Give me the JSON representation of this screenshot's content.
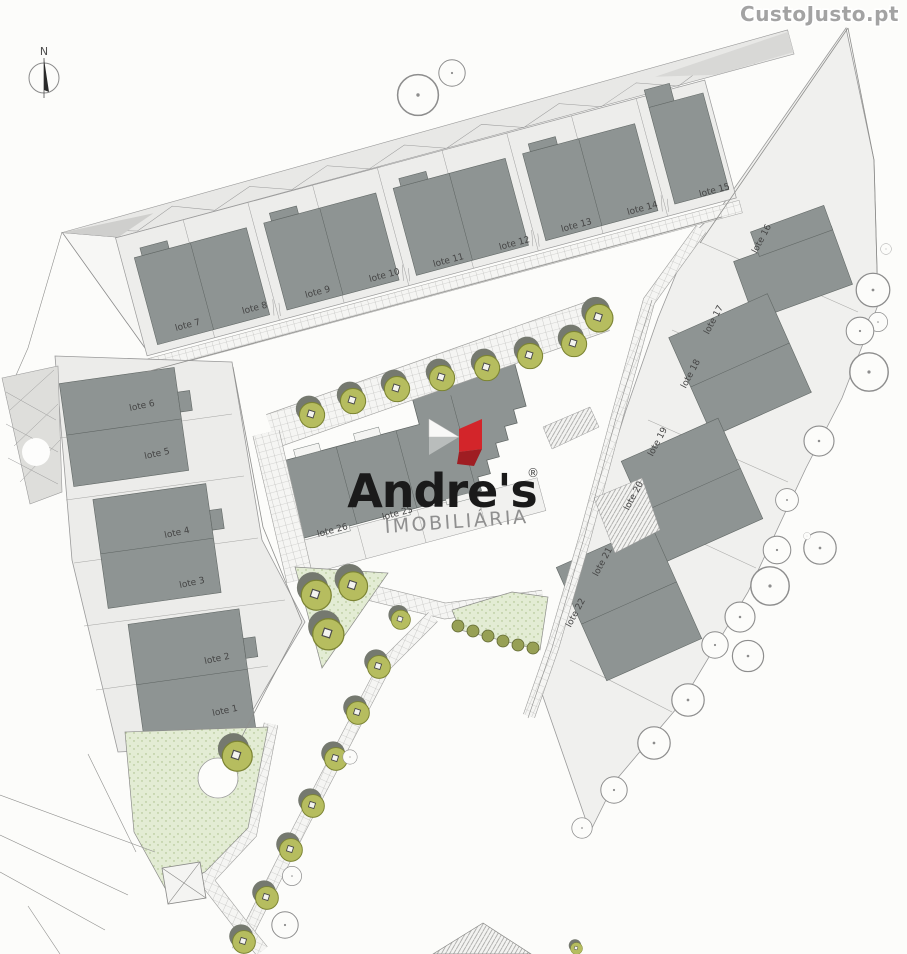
{
  "watermark": {
    "text": "CustoJusto.pt"
  },
  "compass": {
    "label": "N"
  },
  "logo": {
    "brand": "Andre's",
    "registered": "®",
    "tagline": "IMOBILIÁRIA"
  },
  "lots": [
    {
      "label": "lote 1"
    },
    {
      "label": "lote 2"
    },
    {
      "label": "lote 3"
    },
    {
      "label": "lote 4"
    },
    {
      "label": "lote 5"
    },
    {
      "label": "lote 6"
    },
    {
      "label": "lote 7"
    },
    {
      "label": "lote 8"
    },
    {
      "label": "lote 9"
    },
    {
      "label": "lote 10"
    },
    {
      "label": "lote 11"
    },
    {
      "label": "lote 12"
    },
    {
      "label": "lote 13"
    },
    {
      "label": "lote 14"
    },
    {
      "label": "lote 15"
    },
    {
      "label": "lote 16"
    },
    {
      "label": "lote 17"
    },
    {
      "label": "lote 18"
    },
    {
      "label": "lote 19"
    },
    {
      "label": "lote 20"
    },
    {
      "label": "lote 21"
    },
    {
      "label": "lote 22"
    },
    {
      "label": "lote 25"
    },
    {
      "label": "lote 26"
    }
  ],
  "colors": {
    "building": "#8e9493",
    "parcel": "#ececea",
    "olive_tree": "#b6bd5f",
    "green_area": "#e3ecd4",
    "logo_red": "#d3252a",
    "watermark_gray": "#a3a3a3"
  }
}
